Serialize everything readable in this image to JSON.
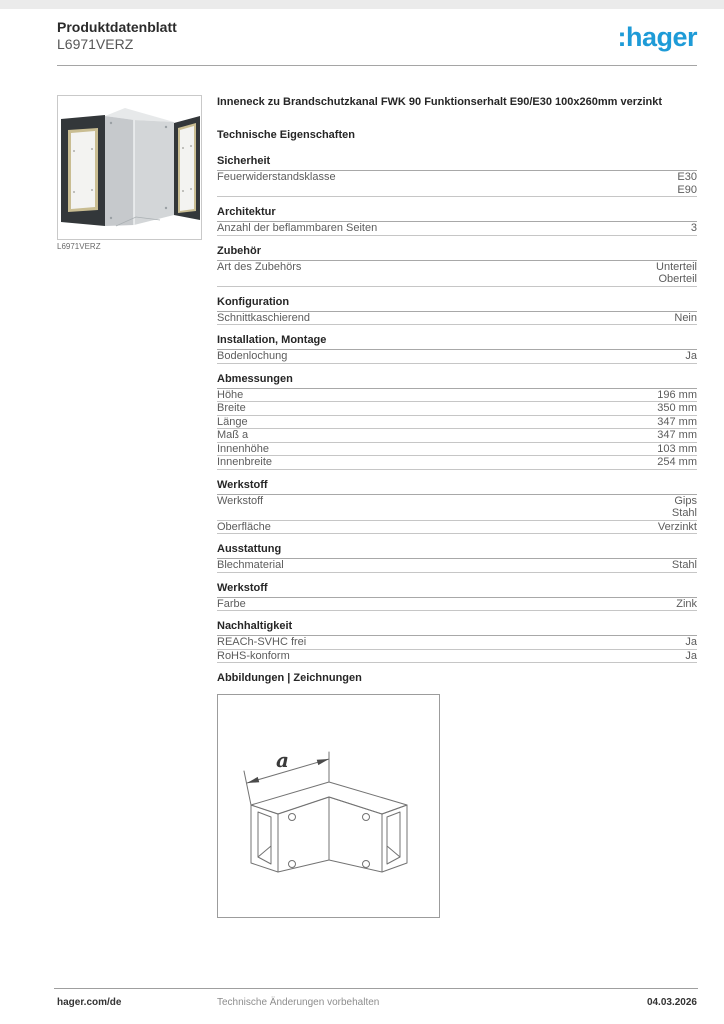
{
  "header": {
    "doc_type": "Produktdatenblatt",
    "product_ref": "L6971VERZ",
    "brand": ":hager",
    "brand_color": "#1e9bd7"
  },
  "product": {
    "image_caption": "L6971VERZ"
  },
  "title": "Inneneck zu Brandschutzkanal FWK 90 Funktionserhalt E90/E30 100x260mm verzinkt",
  "tech_heading": "Technische Eigenschaften",
  "sections": [
    {
      "heading": "Sicherheit",
      "rows": [
        {
          "label": "Feuerwiderstandsklasse",
          "values": [
            "E30",
            "E90"
          ]
        }
      ]
    },
    {
      "heading": "Architektur",
      "rows": [
        {
          "label": "Anzahl der beflammbaren Seiten",
          "values": [
            "3"
          ]
        }
      ]
    },
    {
      "heading": "Zubehör",
      "rows": [
        {
          "label": "Art des Zubehörs",
          "values": [
            "Unterteil",
            "Oberteil"
          ]
        }
      ]
    },
    {
      "heading": "Konfiguration",
      "rows": [
        {
          "label": "Schnittkaschierend",
          "values": [
            "Nein"
          ]
        }
      ]
    },
    {
      "heading": "Installation, Montage",
      "rows": [
        {
          "label": "Bodenlochung",
          "values": [
            "Ja"
          ]
        }
      ]
    },
    {
      "heading": "Abmessungen",
      "rows": [
        {
          "label": "Höhe",
          "values": [
            "196 mm"
          ]
        },
        {
          "label": "Breite",
          "values": [
            "350 mm"
          ]
        },
        {
          "label": "Länge",
          "values": [
            "347 mm"
          ]
        },
        {
          "label": "Maß a",
          "values": [
            "347 mm"
          ]
        },
        {
          "label": "Innenhöhe",
          "values": [
            "103 mm"
          ]
        },
        {
          "label": "Innenbreite",
          "values": [
            "254 mm"
          ]
        }
      ]
    },
    {
      "heading": "Werkstoff",
      "rows": [
        {
          "label": "Werkstoff",
          "values": [
            "Gips",
            "Stahl"
          ]
        },
        {
          "label": "Oberfläche",
          "values": [
            "Verzinkt"
          ]
        }
      ]
    },
    {
      "heading": "Ausstattung",
      "rows": [
        {
          "label": "Blechmaterial",
          "values": [
            "Stahl"
          ]
        }
      ]
    },
    {
      "heading": "Werkstoff",
      "rows": [
        {
          "label": "Farbe",
          "values": [
            "Zink"
          ]
        }
      ]
    },
    {
      "heading": "Nachhaltigkeit",
      "rows": [
        {
          "label": "REACh-SVHC frei",
          "values": [
            "Ja"
          ]
        },
        {
          "label": "RoHS-konform",
          "values": [
            "Ja"
          ]
        }
      ]
    }
  ],
  "drawings": {
    "heading": "Abbildungen | Zeichnungen",
    "dimension_label": "a"
  },
  "footer": {
    "website": "hager.com/de",
    "notice": "Technische Änderungen vorbehalten",
    "date": "04.03.2026"
  }
}
